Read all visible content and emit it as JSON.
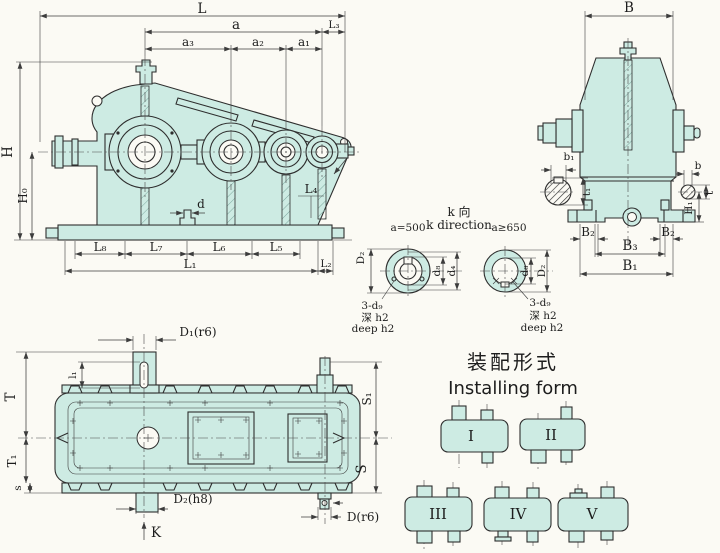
{
  "colors": {
    "background": "#fbfaf4",
    "housing_fill": "#cdebe3",
    "line": "#2e2e2e"
  },
  "side_view": {
    "labels": {
      "L": "L",
      "a": "a",
      "L3": "L₃",
      "a3": "a₃",
      "a2": "a₂",
      "a1": "a₁",
      "H": "H",
      "H0": "H₀",
      "d": "d",
      "L8": "L₈",
      "L7": "L₇",
      "L6": "L₆",
      "L5": "L₅",
      "L4": "L₄",
      "L1": "L₁",
      "L2": "L₂"
    }
  },
  "end_view": {
    "labels": {
      "B": "B",
      "b1": "b₁",
      "t1": "t₁",
      "b": "b",
      "t": "t",
      "H1": "H₁",
      "B2L": "B₂",
      "B2R": "B₂",
      "B3": "B₃",
      "B1": "B₁"
    }
  },
  "shaft_detail": {
    "k_label_cn": "k 向",
    "k_label_en": "k direction",
    "left": {
      "condition": "a=500",
      "D2": "D₂",
      "d8": "d₈",
      "d4": "d₄",
      "holes": "3-d₉",
      "depth_cn": "深 h2",
      "depth_en": "deep h2"
    },
    "right": {
      "condition": "a≥650",
      "d8": "d₈",
      "D2": "D₂",
      "holes": "3-d₉",
      "depth_cn": "深 h2",
      "depth_en": "deep h2"
    }
  },
  "top_view": {
    "labels": {
      "D1": "D₁(r6)",
      "l1": "l₁",
      "T": "T",
      "T1": "T₁",
      "s": "s",
      "S1": "S₁",
      "S": "S",
      "D2": "D₂(h8)",
      "D": "D(r6)",
      "K": "K"
    }
  },
  "installing_form": {
    "title_cn": "装配形式",
    "title_en": "Installing form",
    "forms": [
      {
        "label": "I"
      },
      {
        "label": "II"
      },
      {
        "label": "III"
      },
      {
        "label": "IV"
      },
      {
        "label": "V"
      }
    ]
  }
}
